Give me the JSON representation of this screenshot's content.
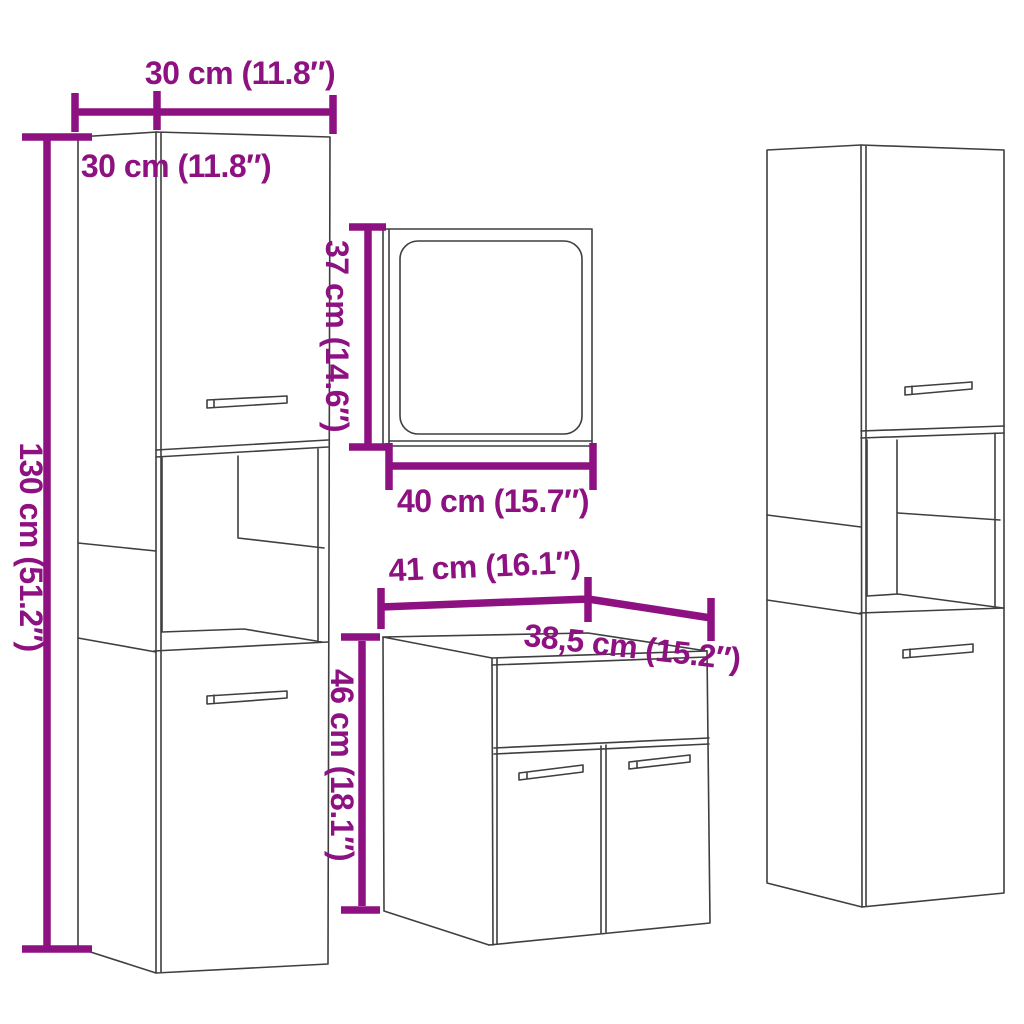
{
  "colors": {
    "dimension_magenta": "#8e1182",
    "outline_gray": "#3f3f3f",
    "background": "#ffffff"
  },
  "diagram": {
    "labels": {
      "cabinet_top_width": "30 cm (11.8″)",
      "cabinet_top_depth": "30 cm (11.8″)",
      "cabinet_height": "130 cm (51.2″)",
      "mirror_height": "37 cm (14.6″)",
      "mirror_width": "40 cm (15.7″)",
      "sink_width": "41 cm (16.1″)",
      "sink_depth": "38,5 cm (15.2″)",
      "sink_height": "46 cm (18.1″)"
    }
  }
}
